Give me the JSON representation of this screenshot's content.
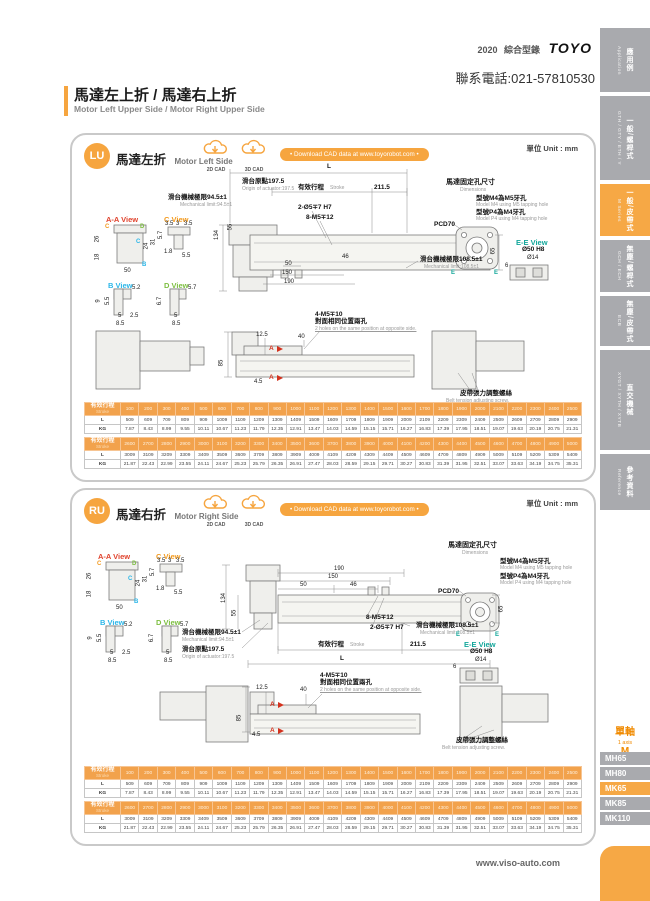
{
  "header": {
    "year": "2020",
    "catalog": "綜合型錄",
    "brand": "TOYO",
    "phone": "聯系電話:021-57810530",
    "title_zh": "馬達左上折 / 馬達右上折",
    "title_en": "Motor Left Upper Side / Motor Right Upper Side"
  },
  "footer": {
    "site": "www.viso-auto.com"
  },
  "sidebar": {
    "tabs": [
      {
        "zh": "應用例",
        "en": "Application"
      },
      {
        "zh": "一般/螺桿式",
        "en": "GTH / GTY / ETH / Y"
      },
      {
        "zh": "一般/皮帶式",
        "en": "M Series"
      },
      {
        "zh": "無塵/螺桿式",
        "en": "GCH / ECH"
      },
      {
        "zh": "無塵/皮帶式",
        "en": "ECB"
      },
      {
        "zh": "直交機械",
        "en": "XYGT / XYTH / XYTB"
      },
      {
        "zh": "參考資料",
        "en": "Reference"
      }
    ],
    "axis": {
      "zh": "單軸",
      "en": "1 axis",
      "series": "M"
    },
    "models": [
      "MH65",
      "MH80",
      "MK65",
      "MK85",
      "MK110"
    ]
  },
  "sections": {
    "lu": {
      "badge": "LU",
      "title_zh": "馬達左折",
      "title_en": "Motor Left Side"
    },
    "ru": {
      "badge": "RU",
      "title_zh": "馬達右折",
      "title_en": "Motor Right Side"
    }
  },
  "common": {
    "cad2d": "2D CAD",
    "cad3d": "3D CAD",
    "download": "• Download CAD data at www.toyorobot.com •",
    "unit": "單位 Unit : mm",
    "views": {
      "aa": "A-A View",
      "c": "C View",
      "b": "B View",
      "d": "D View",
      "ee": "E-E View"
    },
    "markers": [
      "C",
      "D",
      "C",
      "B"
    ],
    "aa_dims": [
      "26",
      "18",
      "50",
      "31",
      "24"
    ],
    "c_dims": [
      "3.5",
      "3",
      "3.5",
      "5.7",
      "1.8",
      "5.5"
    ],
    "b_dims": [
      "9",
      "5.5",
      "5.2",
      "5",
      "2.5",
      "8.5"
    ],
    "d_dims": [
      "6.7",
      "5.7",
      "5",
      "8.5"
    ],
    "main": {
      "L": "L",
      "origin_zh": "滑台原點197.5",
      "origin_en": "Origin of actuator:197.5",
      "stroke_zh": "有效行程",
      "stroke_en": "Stroke",
      "end": "211.5",
      "mech_low_zh": "滑台機械極限94.5±1",
      "mech_low_en": "Mechanical limit:94.5±1",
      "mech_high_zh": "滑台機械極限108.5±1",
      "mech_high_en": "Mechanical limit:108.5±1",
      "pin": "2-Ø5∓7 H7",
      "tap": "8-M5∓12",
      "d134": "134",
      "d55": "55",
      "d50": "50",
      "d150": "150",
      "d190": "190",
      "d46": "46",
      "d65": "65"
    },
    "motor": {
      "title_zh": "馬達固定孔尺寸",
      "title_en": "Dimensions",
      "m4_zh": "型號M4為M5牙孔",
      "m4_en": "Model M4 using M5 tapping hole",
      "p4_zh": "型號P4為M4牙孔",
      "p4_en": "Model P4 using M4 tapping hole",
      "pcd": "PCD70",
      "e": "E",
      "ee_d50": "Ø50 H8",
      "ee_d14": "Ø14",
      "ee_d6": "6"
    },
    "side": {
      "d125": "12.5",
      "d40": "40",
      "d85": "85",
      "d45": "4.5",
      "a": "A",
      "tap4_1": "4-M5∓10",
      "tap4_2": "對面相同位置兩孔",
      "tap4_3": "2 holes on the same position at opposite side.",
      "belt_zh": "皮帶張力調整螺絲",
      "belt_en": "Belt tension adjusting screw."
    }
  },
  "stroke_table": {
    "header_zh": "有效行程",
    "header_en": "Stroke",
    "row_l": "L",
    "row_kg": "KG",
    "blocks": [
      {
        "strokes": [
          "100",
          "200",
          "300",
          "400",
          "500",
          "600",
          "700",
          "800",
          "900",
          "1000",
          "1100",
          "1200",
          "1300",
          "1400",
          "1500",
          "1600",
          "1700",
          "1800",
          "1900",
          "2000",
          "2100",
          "2200",
          "2300",
          "2400",
          "2500"
        ],
        "l": [
          "509",
          "609",
          "709",
          "809",
          "909",
          "1009",
          "1109",
          "1209",
          "1309",
          "1409",
          "1509",
          "1609",
          "1709",
          "1809",
          "1909",
          "2009",
          "2109",
          "2209",
          "2309",
          "2409",
          "2509",
          "2609",
          "2709",
          "2809",
          "2909"
        ],
        "kg": [
          "7.87",
          "8.43",
          "8.99",
          "9.55",
          "10.11",
          "10.67",
          "11.23",
          "11.79",
          "12.35",
          "12.91",
          "13.47",
          "14.03",
          "14.59",
          "15.15",
          "15.71",
          "16.27",
          "16.83",
          "17.39",
          "17.95",
          "18.51",
          "19.07",
          "19.63",
          "20.19",
          "20.75",
          "21.31"
        ]
      },
      {
        "strokes": [
          "2600",
          "2700",
          "2800",
          "2900",
          "3000",
          "3100",
          "3200",
          "3300",
          "3400",
          "3500",
          "3600",
          "3700",
          "3800",
          "3900",
          "4000",
          "4100",
          "4200",
          "4300",
          "4400",
          "4500",
          "4600",
          "4700",
          "4800",
          "4900",
          "5000"
        ],
        "l": [
          "3009",
          "3109",
          "3209",
          "3309",
          "3409",
          "3509",
          "3609",
          "3709",
          "3809",
          "3909",
          "4009",
          "4109",
          "4209",
          "4309",
          "4409",
          "4509",
          "4609",
          "4709",
          "4809",
          "4909",
          "5009",
          "5109",
          "5209",
          "5309",
          "5409"
        ],
        "kg": [
          "21.87",
          "22.43",
          "22.99",
          "23.55",
          "24.11",
          "24.67",
          "25.23",
          "25.79",
          "26.35",
          "26.91",
          "27.47",
          "28.03",
          "28.59",
          "29.15",
          "29.71",
          "30.27",
          "30.83",
          "31.39",
          "31.95",
          "32.51",
          "33.07",
          "33.63",
          "34.19",
          "34.75",
          "35.31"
        ]
      }
    ]
  }
}
